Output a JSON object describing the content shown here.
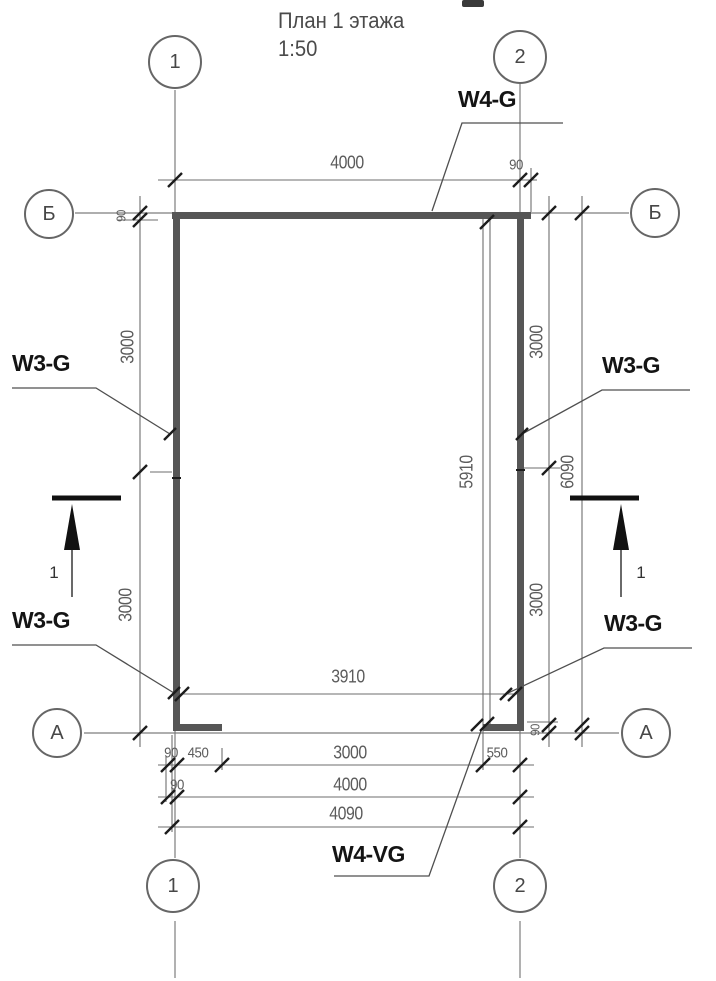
{
  "title": {
    "line1": "План 1 этажа",
    "scale": "1:50"
  },
  "axes": {
    "col1": "1",
    "col2": "2",
    "rowB": "Б",
    "rowA": "А"
  },
  "wall_tags": {
    "top": "W4-G",
    "left_upper": "W3-G",
    "left_lower": "W3-G",
    "right_upper": "W3-G",
    "right_lower": "W3-G",
    "bottom": "W4-VG"
  },
  "section": {
    "label": "1"
  },
  "dims": {
    "top_width": "4000",
    "top_right_offset": "90",
    "left_upper": "3000",
    "left_lower": "3000",
    "left_thickness": "90",
    "right_upper": "3000",
    "right_lower": "3000",
    "right_total": "6090",
    "right_thickness": "90",
    "inner_width": "3910",
    "inner_height": "5910",
    "row1_a": "90",
    "row1_b": "450",
    "row1_c": "3000",
    "row1_d": "550",
    "row2_a": "90",
    "row2_b": "4000",
    "row3_total": "4090"
  },
  "colors": {
    "wall": "#565656",
    "grid": "#7d7d7d",
    "tick": "#1c1c1c",
    "leader": "#4f4f4f"
  }
}
